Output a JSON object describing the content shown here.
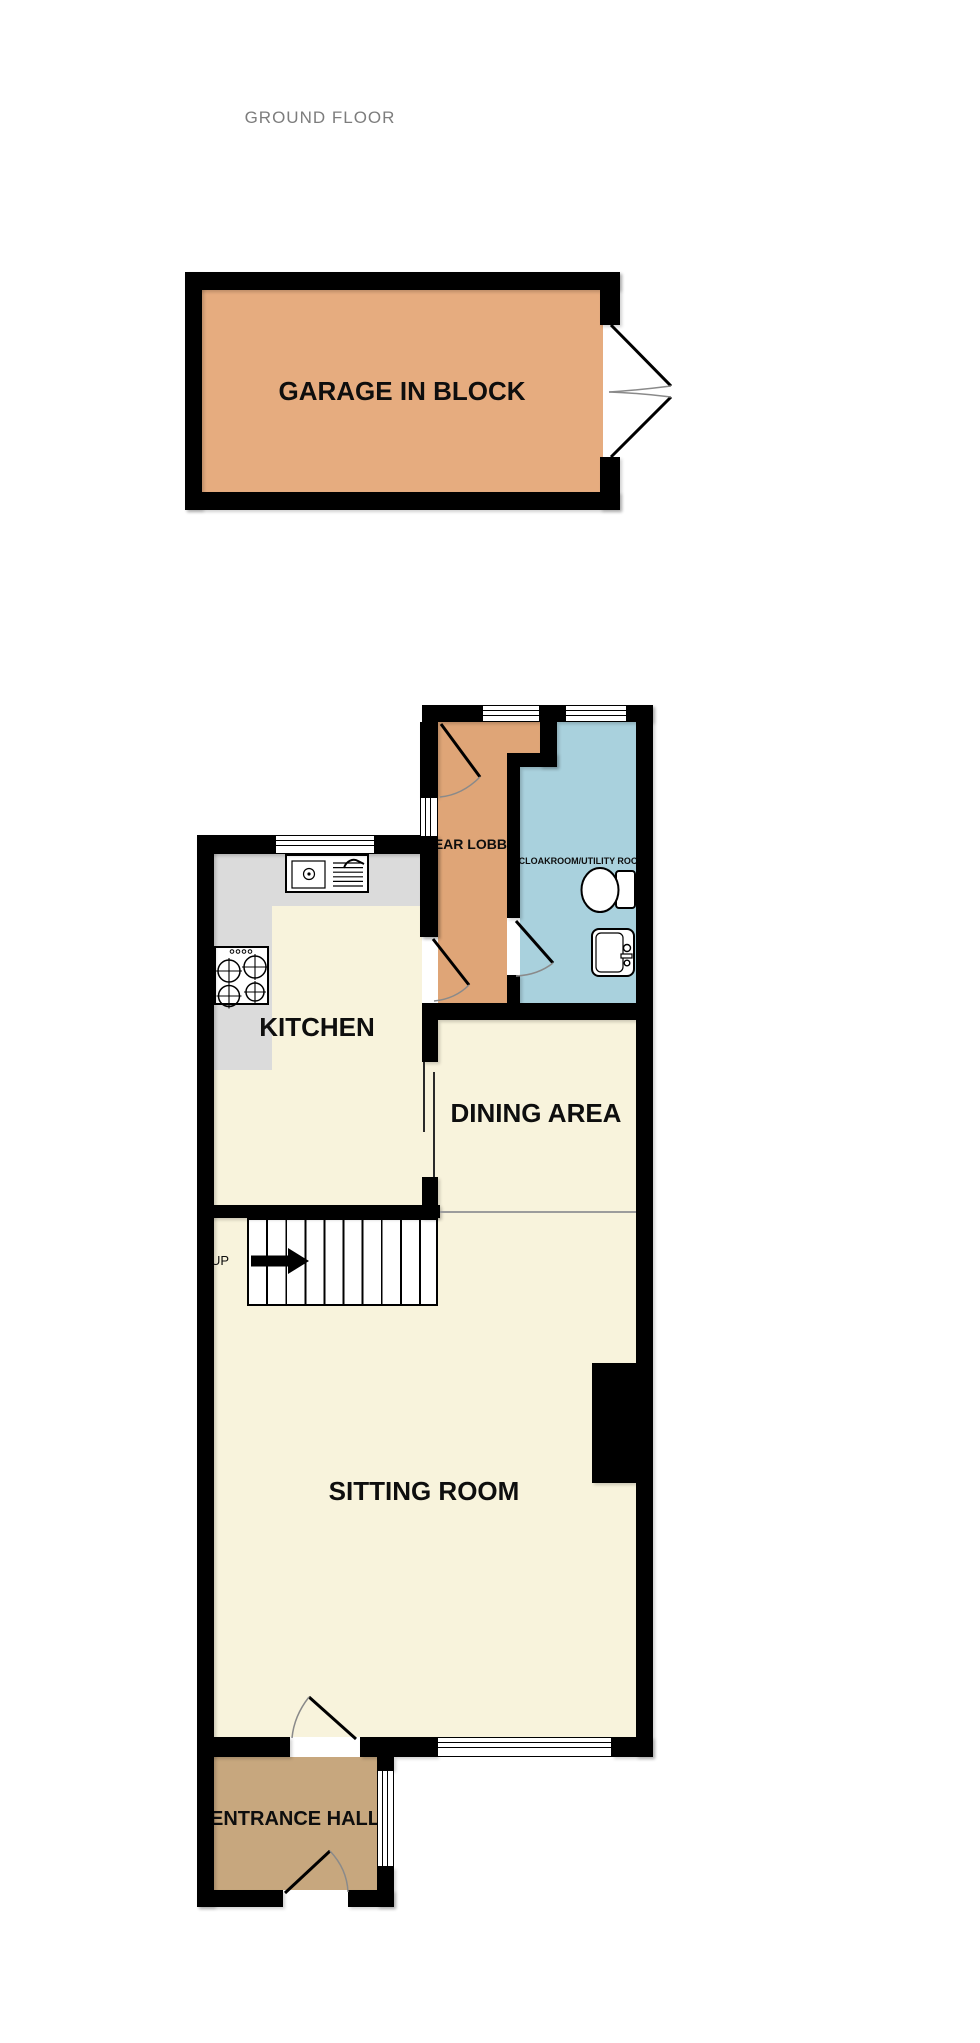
{
  "title": "GROUND FLOOR",
  "rooms": {
    "garage": {
      "name": "GARAGE IN BLOCK"
    },
    "rear_lobby": {
      "name": "REAR LOBBY"
    },
    "cloakroom": {
      "name": "CLOAKROOM/UTILITY ROOM"
    },
    "kitchen": {
      "name": "KITCHEN"
    },
    "dining_area": {
      "name": "DINING AREA"
    },
    "sitting_room": {
      "name": "SITTING ROOM"
    },
    "entrance_hall": {
      "name": "ENTRANCE HALL"
    }
  },
  "stairs": {
    "label": "UP"
  },
  "icons": {
    "toilet": "toilet-icon",
    "basin": "basin-icon",
    "hob": "hob-icon",
    "kitchen_sink": "kitchen-sink-icon",
    "door_swing": "door-swing-icon",
    "garage_door": "garage-double-door-icon",
    "up_arrow": "up-arrow-icon",
    "window": "window-symbol"
  },
  "colors": {
    "wall": "#000000",
    "garage_floor": "#E6AC7F",
    "lobby_floor": "#DFA577",
    "cloakroom_floor": "#A9D1DD",
    "cream_floor": "#F8F3DC",
    "counter": "#DBDBDB",
    "hall_floor": "#C7A77E",
    "title_text": "#7D7D7D",
    "label_text": "#0E0E0E",
    "door_arc": "#8A8A8A",
    "openplan_line": "#9C9C9C"
  }
}
